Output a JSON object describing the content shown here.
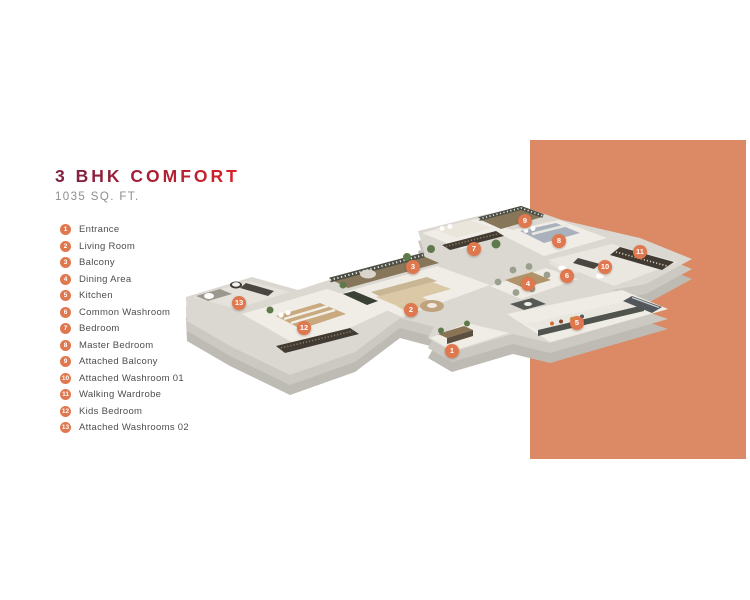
{
  "title": {
    "heading": "3 BHK COMFORT",
    "area": "1035 SQ. FT."
  },
  "colors": {
    "side_panel": "#dc8965",
    "badge": "#e0784f",
    "heading_gradient_start": "#7c2144",
    "heading_gradient_end": "#db2028",
    "legend_text": "#4e4e4e",
    "area_text": "#8e8e8e"
  },
  "legend": {
    "items": [
      {
        "num": "1",
        "label": "Entrance"
      },
      {
        "num": "2",
        "label": "Living Room"
      },
      {
        "num": "3",
        "label": "Balcony"
      },
      {
        "num": "4",
        "label": "Dining Area"
      },
      {
        "num": "5",
        "label": "Kitchen"
      },
      {
        "num": "6",
        "label": "Common Washroom"
      },
      {
        "num": "7",
        "label": "Bedroom"
      },
      {
        "num": "8",
        "label": "Master Bedroom"
      },
      {
        "num": "9",
        "label": "Attached Balcony"
      },
      {
        "num": "10",
        "label": "Attached Washroom 01"
      },
      {
        "num": "11",
        "label": "Walking Wardrobe"
      },
      {
        "num": "12",
        "label": "Kids Bedroom"
      },
      {
        "num": "13",
        "label": "Attached Washrooms 02"
      }
    ]
  }
}
